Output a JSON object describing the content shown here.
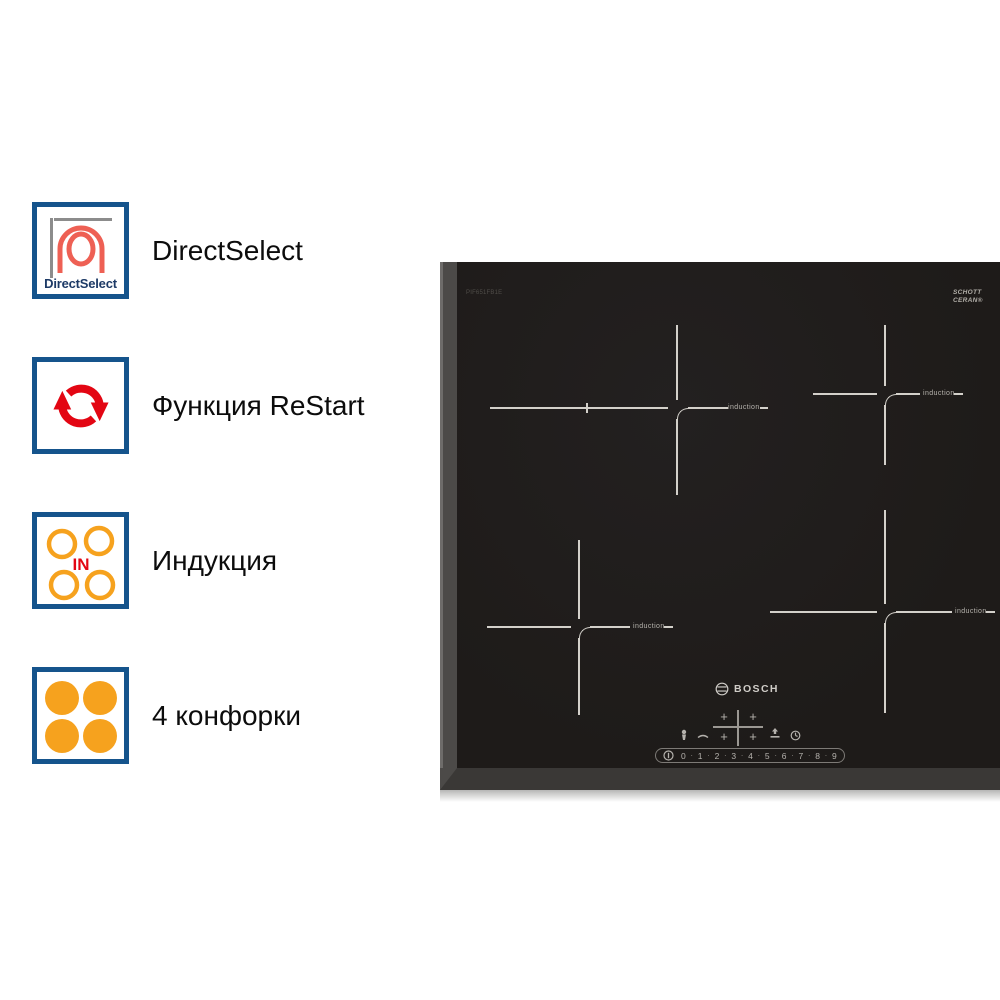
{
  "features": [
    {
      "label": "DirectSelect",
      "badge_caption": "DirectSelect",
      "icon": "directselect-coil-icon"
    },
    {
      "label": "Функция ReStart",
      "icon": "restart-arrows-icon"
    },
    {
      "label": "Индукция",
      "icon_caption": "IN",
      "icon": "induction-rings-icon"
    },
    {
      "label": "4 конфорки",
      "icon": "four-burners-icon"
    }
  ],
  "cooktop": {
    "brand_logo": "BOSCH",
    "model_label": "PIF651FB1E",
    "glass_brand": {
      "line1": "SCHOTT",
      "line2": "CERAN®"
    },
    "zone_label": "induction",
    "controls": {
      "power_levels": [
        "0",
        "1",
        "2",
        "3",
        "4",
        "5",
        "6",
        "7",
        "8",
        "9"
      ]
    }
  },
  "colors": {
    "badge_border_blue": "#15548c",
    "bosch_red": "#e30613",
    "coil_salmon": "#ee6054",
    "burner_orange": "#f6a21e",
    "glass_black": "#201d1b",
    "zone_line": "#d3d0ca",
    "panel_glyph": "#b5b2ad"
  }
}
